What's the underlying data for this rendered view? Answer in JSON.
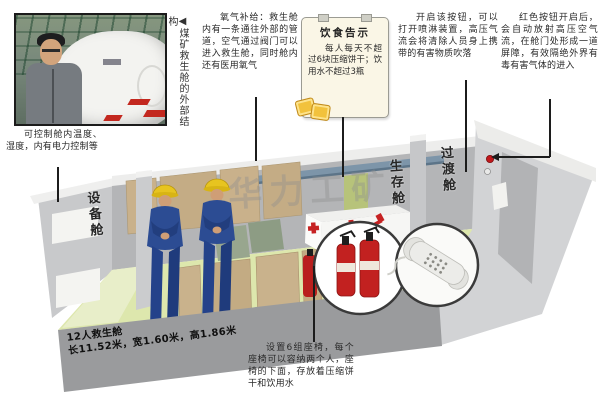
{
  "photo": {
    "caption": "◀煤矿救生舱的外部结构"
  },
  "annotations": {
    "oxygen": "氧气补给：救生舱内有一条通往外部的管道，空气通过阀门可以进入救生舱，同时舱内还有医用氧气",
    "food_notice": {
      "title": "饮食告示",
      "body": "每人每天不超过6块压缩饼干；饮用水不超过3瓶"
    },
    "spray_button": "开启该按钮，可以打开喷淋装置，高压气流会将清除人员身上携带的有害物质吹落",
    "red_button": "红色按钮开启后，会自动放射高压空气流，在舱门处形成一道屏障，有效隔绝外界有毒有害气体的进入",
    "climate_control": "可控制舱内温度、湿度，内有电力控制等",
    "seats_note": "设置6组座椅，每个座椅可以容纳两个人，座椅的下面，存放着压缩饼干和饮用水"
  },
  "capsule": {
    "cabin_labels": {
      "equipment": "设备舱",
      "survival": "生存舱",
      "transition": "过渡舱"
    },
    "dimensions": {
      "line1": "12人救生舱",
      "line2": "长11.52米，宽1.60米，高1.86米"
    }
  },
  "watermark": "华力工矿",
  "colors": {
    "wall_gray": "#b4b5b7",
    "floor_green": "#dde7ad",
    "seat_tan": "#c9b18b",
    "uniform_blue": "#2c4c93",
    "helmet_yellow": "#e7c41f",
    "emergency_red": "#c22120",
    "pipe_blue": "#7d95a9",
    "wall_panel_green": "#b7c37a"
  }
}
